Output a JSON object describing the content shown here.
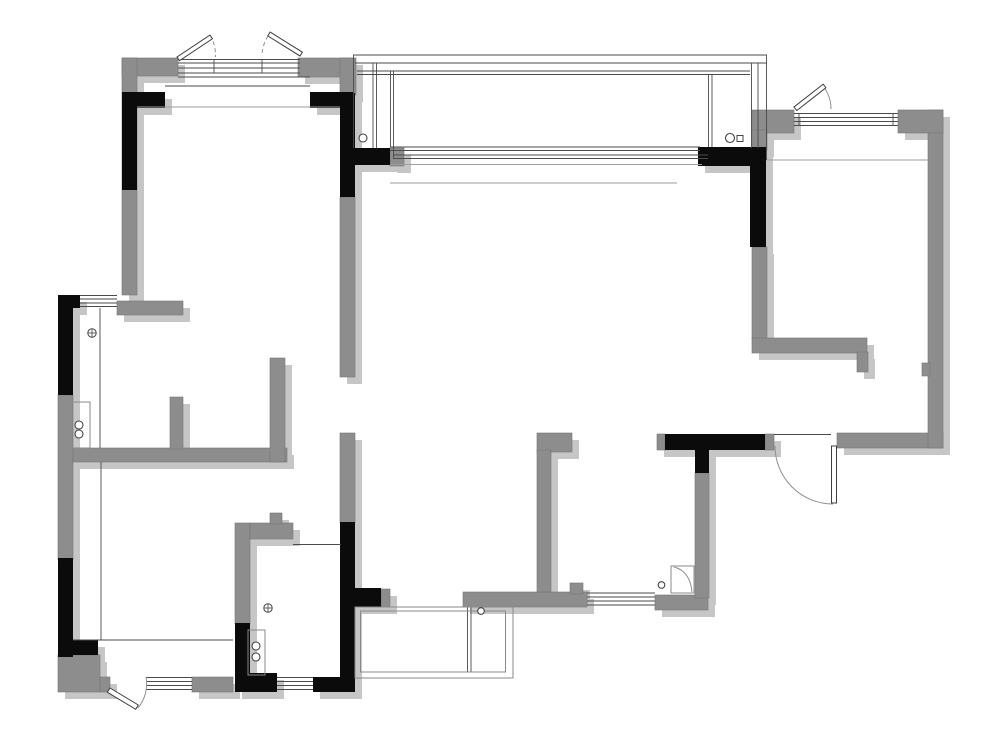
{
  "canvas": {
    "width": 1000,
    "height": 748,
    "background": "#ffffff"
  },
  "palette": {
    "wall_gray": "#8d8d8d",
    "wall_edge": "#757575",
    "column_black": "#0b0b0b",
    "shadow": "#c6c6c6",
    "shadow_dx": 7,
    "shadow_dy": 7,
    "line_dark": "#4a4a4a",
    "line_light": "#9e9e9e",
    "arc_color": "#8f8f8f",
    "leaf_fill": "#ffffff",
    "leaf_stroke": "#3f3f3f",
    "fixture_stroke": "#8a8a8a",
    "symbol_stroke": "#444444"
  },
  "plan": {
    "gray_walls": [
      [
        122,
        58,
        56,
        18
      ],
      [
        122,
        58,
        15,
        237
      ],
      [
        298,
        58,
        55,
        19
      ],
      [
        340,
        58,
        16,
        37
      ],
      [
        117,
        301,
        66,
        14
      ],
      [
        58,
        395,
        15,
        165
      ],
      [
        73,
        448,
        214,
        14
      ],
      [
        170,
        397,
        13,
        52
      ],
      [
        270,
        358,
        15,
        104
      ],
      [
        340,
        197,
        15,
        180
      ],
      [
        340,
        433,
        15,
        90
      ],
      [
        235,
        523,
        15,
        101
      ],
      [
        250,
        523,
        43,
        16
      ],
      [
        270,
        513,
        12,
        11
      ],
      [
        390,
        148,
        14,
        18
      ],
      [
        381,
        589,
        9,
        18
      ],
      [
        463,
        592,
        124,
        15
      ],
      [
        655,
        595,
        53,
        15
      ],
      [
        570,
        583,
        13,
        11
      ],
      [
        537,
        433,
        35,
        19
      ],
      [
        537,
        450,
        14,
        142
      ],
      [
        695,
        473,
        14,
        125
      ],
      [
        657,
        434,
        8,
        16
      ],
      [
        765,
        434,
        9,
        16
      ],
      [
        837,
        433,
        106,
        15
      ],
      [
        928,
        110,
        15,
        338
      ],
      [
        752,
        110,
        42,
        23
      ],
      [
        898,
        110,
        45,
        23
      ],
      [
        752,
        130,
        15,
        20
      ],
      [
        752,
        247,
        15,
        92
      ],
      [
        752,
        338,
        115,
        15
      ],
      [
        857,
        352,
        11,
        20
      ],
      [
        192,
        677,
        41,
        15
      ],
      [
        58,
        655,
        42,
        37
      ],
      [
        100,
        677,
        10,
        15
      ],
      [
        922,
        363,
        8,
        13
      ]
    ],
    "black_columns": [
      [
        122,
        92,
        43,
        16
      ],
      [
        122,
        92,
        15,
        98
      ],
      [
        310,
        92,
        43,
        16
      ],
      [
        340,
        93,
        15,
        104
      ],
      [
        340,
        148,
        50,
        17
      ],
      [
        698,
        147,
        68,
        19
      ],
      [
        750,
        148,
        16,
        99
      ],
      [
        58,
        295,
        22,
        13
      ],
      [
        58,
        295,
        15,
        100
      ],
      [
        58,
        558,
        15,
        99
      ],
      [
        58,
        640,
        40,
        15
      ],
      [
        235,
        623,
        15,
        54
      ],
      [
        235,
        673,
        42,
        19
      ],
      [
        313,
        677,
        42,
        15
      ],
      [
        340,
        522,
        15,
        168
      ],
      [
        355,
        588,
        26,
        19
      ],
      [
        665,
        434,
        100,
        16
      ],
      [
        695,
        448,
        14,
        25
      ]
    ],
    "dark_lines": [
      [
        178,
        59.5,
        300,
        59.5
      ],
      [
        178,
        63,
        300,
        63
      ],
      [
        178,
        68,
        300,
        68
      ],
      [
        178,
        73,
        300,
        73
      ],
      [
        214,
        59.5,
        214,
        73
      ],
      [
        262,
        59.5,
        262,
        73
      ],
      [
        178,
        77,
        310,
        77
      ],
      [
        165,
        86,
        310,
        86
      ],
      [
        80,
        295.5,
        117,
        295.5
      ],
      [
        80,
        299,
        117,
        299
      ],
      [
        80,
        303,
        117,
        303
      ],
      [
        80,
        306.5,
        117,
        306.5
      ],
      [
        146,
        677.5,
        192,
        677.5
      ],
      [
        146,
        681.5,
        192,
        681.5
      ],
      [
        146,
        685.5,
        192,
        685.5
      ],
      [
        146,
        689.5,
        192,
        689.5
      ],
      [
        277,
        677.5,
        313,
        677.5
      ],
      [
        277,
        681.5,
        313,
        681.5
      ],
      [
        277,
        685.5,
        313,
        685.5
      ],
      [
        277,
        689.5,
        313,
        689.5
      ],
      [
        587,
        593,
        655,
        593
      ],
      [
        587,
        597,
        655,
        597
      ],
      [
        587,
        601,
        655,
        601
      ],
      [
        587,
        605,
        655,
        605
      ],
      [
        794,
        113.5,
        898,
        113.5
      ],
      [
        794,
        117.5,
        898,
        117.5
      ],
      [
        794,
        121.5,
        898,
        121.5
      ],
      [
        794,
        125.5,
        898,
        125.5
      ],
      [
        799,
        113.5,
        799,
        125.5
      ],
      [
        893,
        113.5,
        893,
        125.5
      ],
      [
        390,
        147,
        700,
        147
      ],
      [
        390,
        150.5,
        700,
        150.5
      ],
      [
        393,
        155,
        708,
        155
      ],
      [
        393,
        158.5,
        708,
        158.5
      ],
      [
        353,
        55,
        767,
        55
      ],
      [
        355,
        63,
        767,
        63
      ],
      [
        357,
        71,
        750,
        71
      ],
      [
        357,
        74.5,
        750,
        74.5
      ],
      [
        353.5,
        55,
        353.5,
        148
      ],
      [
        373,
        63,
        373,
        148
      ],
      [
        376.5,
        63,
        376.5,
        148
      ],
      [
        390.5,
        71,
        390.5,
        147
      ],
      [
        393.5,
        71,
        393.5,
        158
      ],
      [
        766.5,
        55,
        766.5,
        160
      ],
      [
        758,
        63,
        758,
        148
      ],
      [
        751.5,
        63,
        751.5,
        148
      ],
      [
        708.5,
        74.5,
        708.5,
        147
      ],
      [
        712,
        74.5,
        712,
        147
      ],
      [
        774,
        434.5,
        831,
        434.5
      ],
      [
        293,
        544.5,
        341,
        544.5
      ],
      [
        100,
        308,
        100,
        448
      ],
      [
        101,
        462,
        101,
        640
      ],
      [
        73,
        640,
        233,
        640
      ],
      [
        467.5,
        607,
        467.5,
        672
      ],
      [
        471,
        607,
        471,
        672
      ]
    ],
    "light_lines": [
      [
        137,
        107,
        340,
        107
      ],
      [
        767,
        160,
        928,
        160
      ],
      [
        390,
        183,
        677,
        183
      ],
      [
        390,
        164.5,
        702,
        164.5
      ]
    ],
    "fixture_rects": [
      [
        72,
        402,
        18,
        46
      ],
      [
        248,
        630,
        17,
        45
      ],
      [
        671,
        566,
        23,
        27
      ],
      [
        355,
        607,
        158,
        71
      ],
      [
        360.5,
        611,
        145,
        61
      ]
    ],
    "door_leaves": [
      {
        "tx": 836.5,
        "ty": 446,
        "rot": 90,
        "len": 57,
        "th": 5
      },
      {
        "tx": 110,
        "ty": 688,
        "rot": 31,
        "len": 33,
        "th": 5
      },
      {
        "tx": 177,
        "ty": 57,
        "rot": -33.7,
        "len": 39.6,
        "th": 4.5
      },
      {
        "tx": 300,
        "ty": 56,
        "rot": -148,
        "len": 38,
        "th": 4.5
      },
      {
        "tx": 794,
        "ty": 107,
        "rot": -38,
        "len": 37,
        "th": 4.5
      }
    ],
    "solid_arcs": [
      "M 775 446 A 58 58 0 0 0 833 504",
      "M 138 708 A 38 38 0 0 0 146 677",
      "M 823 86 A 37 37 0 0 1 831 109",
      "M 674 567 Q 690 571 692 592"
    ],
    "dashed_arcs": [
      "M 210 35 A 40 40 0 0 1 215.5 57",
      "M 268 36 A 38 38 0 0 0 262 56"
    ],
    "circles": [
      [
        363,
        138,
        4
      ],
      [
        730,
        138,
        4.5
      ],
      [
        79,
        425,
        4
      ],
      [
        79,
        434,
        4
      ],
      [
        256,
        646,
        4
      ],
      [
        256,
        657,
        4
      ],
      [
        661.5,
        585,
        3.3
      ],
      [
        481,
        611,
        3.3
      ]
    ],
    "cross_circles": [
      [
        92,
        333,
        4.2
      ],
      [
        268,
        608,
        4.2
      ]
    ],
    "squares": [
      [
        737,
        135.5,
        6
      ]
    ]
  }
}
